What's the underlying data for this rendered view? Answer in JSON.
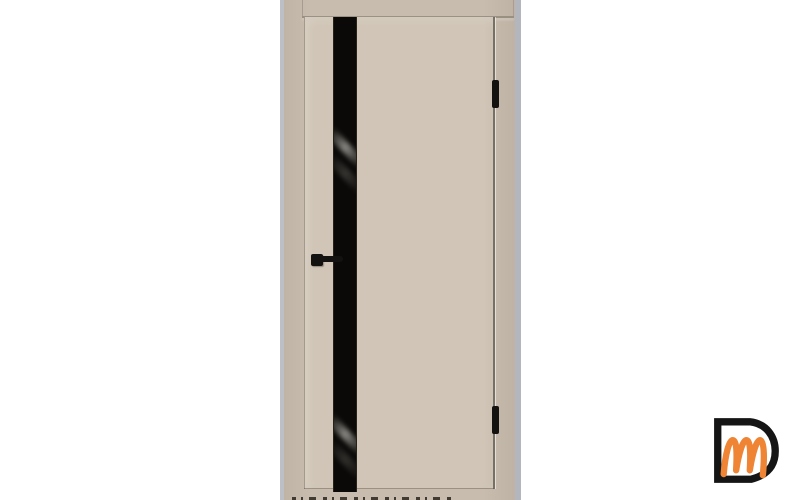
{
  "scene": {
    "type": "product photo",
    "subject": "Interior door, beige finish with vertical black glass insert and black hardware",
    "background_color": "#ffffff"
  },
  "door": {
    "frame_color": "#c8bcae",
    "leaf_color": "#d0c5b6",
    "edge_left_color": "#bcbfc5",
    "edge_right_color": "#b3b6bc",
    "rail_line_color": "#8d8476",
    "gap_color": "#6a6256",
    "glass_color": "#0b0907",
    "hardware_color": "#141210",
    "floor_marks_color": "#29241c"
  },
  "logo": {
    "monogram": "Dm",
    "letter_outer": "D",
    "letter_inner": "m",
    "outer_color": "#151515",
    "inner_color": "#ee8434"
  }
}
